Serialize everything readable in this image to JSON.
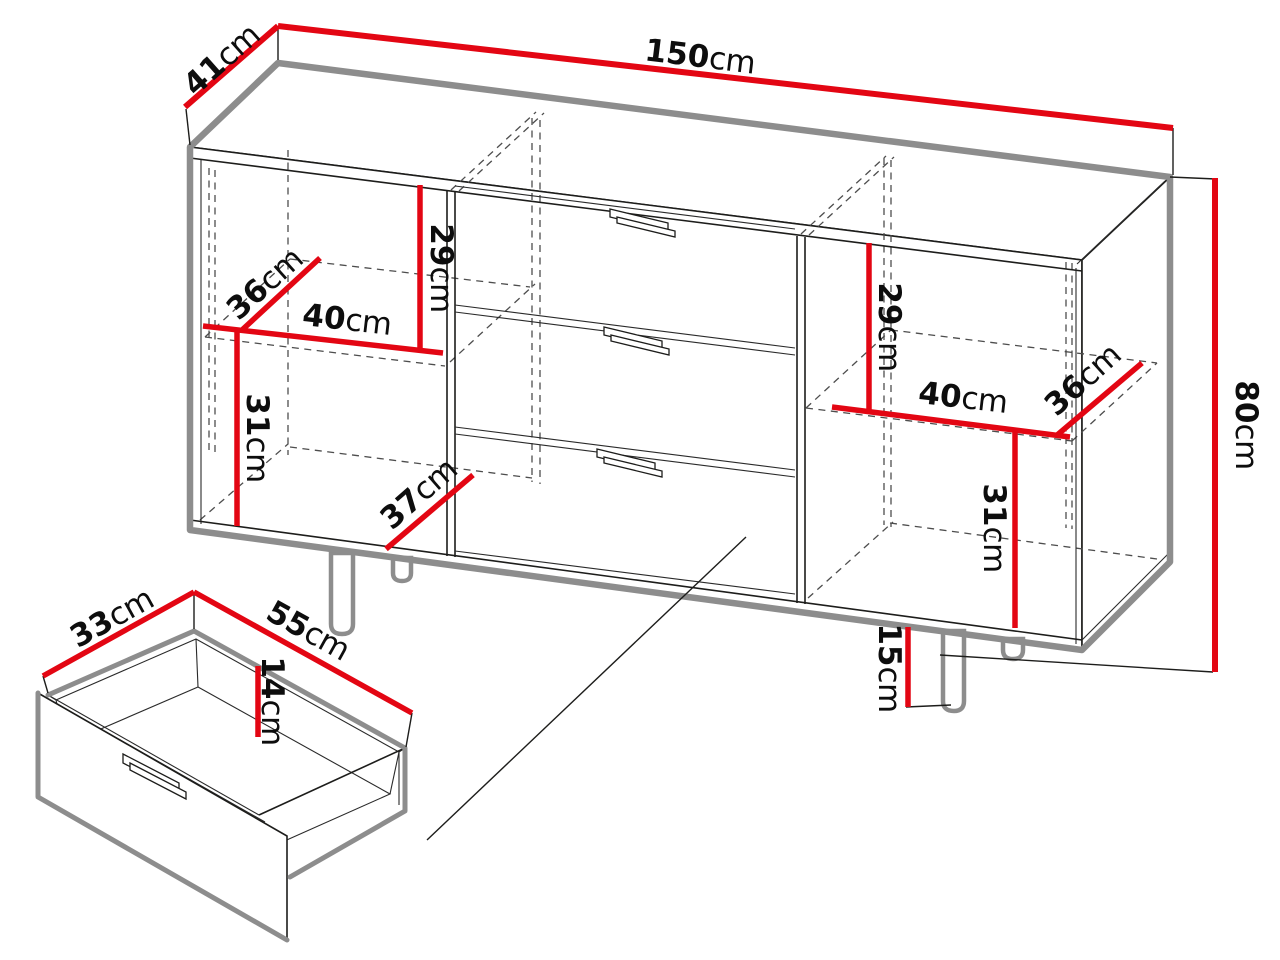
{
  "unit": "cm",
  "colors": {
    "dimension_red": "#e30613",
    "outline_black": "#1d1d1b",
    "silhouette_gray": "#8d8d8d",
    "hidden_line_gray": "#4d4d4d",
    "background": "#ffffff"
  },
  "cabinet": {
    "overall": {
      "width": "150",
      "depth": "41",
      "height": "80"
    },
    "left_compartment": {
      "upper_height": "29",
      "shelf_depth": "36",
      "shelf_width": "40",
      "lower_height": "31",
      "bottom_depth": "37"
    },
    "right_compartment": {
      "upper_height": "29",
      "shelf_width": "40",
      "shelf_depth": "36",
      "lower_height": "31"
    },
    "leg_height": "15",
    "drawer_count": 3
  },
  "drawer_detail": {
    "width": "55",
    "depth": "33",
    "inner_height": "14"
  },
  "labels": {
    "overall_width": {
      "value": "150",
      "unit": "cm"
    },
    "overall_depth": {
      "value": "41",
      "unit": "cm"
    },
    "overall_height": {
      "value": "80",
      "unit": "cm"
    },
    "left_upper_height": {
      "value": "29",
      "unit": "cm"
    },
    "left_shelf_depth": {
      "value": "36",
      "unit": "cm"
    },
    "left_shelf_width": {
      "value": "40",
      "unit": "cm"
    },
    "left_lower_height": {
      "value": "31",
      "unit": "cm"
    },
    "left_bottom_depth": {
      "value": "37",
      "unit": "cm"
    },
    "right_upper_height": {
      "value": "29",
      "unit": "cm"
    },
    "right_shelf_width": {
      "value": "40",
      "unit": "cm"
    },
    "right_shelf_depth": {
      "value": "36",
      "unit": "cm"
    },
    "right_lower_height": {
      "value": "31",
      "unit": "cm"
    },
    "leg_height": {
      "value": "15",
      "unit": "cm"
    },
    "drawer_depth": {
      "value": "33",
      "unit": "cm"
    },
    "drawer_width": {
      "value": "55",
      "unit": "cm"
    },
    "drawer_inner_height": {
      "value": "14",
      "unit": "cm"
    }
  }
}
